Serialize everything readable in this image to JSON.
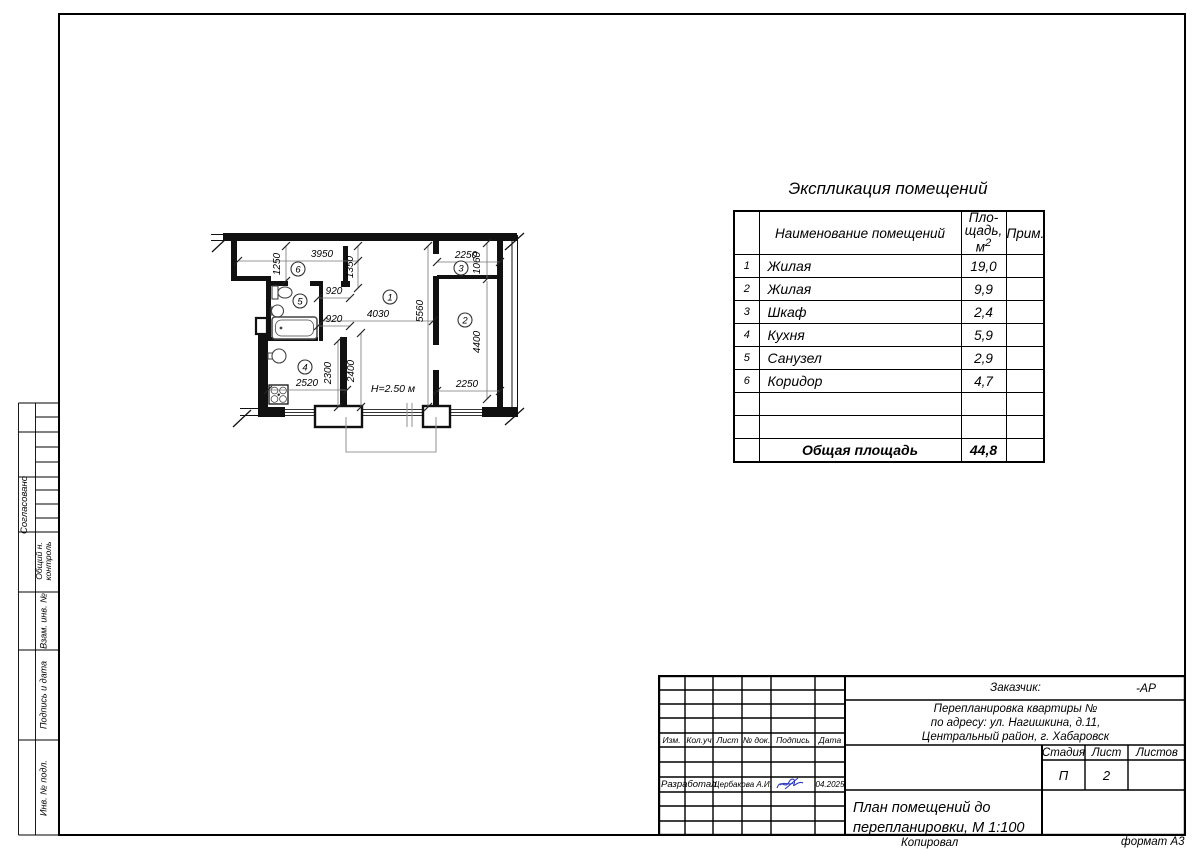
{
  "explication": {
    "title": "Экспликация помещений",
    "header": {
      "name": "Наименование помещений",
      "area_l1": "Пло-",
      "area_l2": "щадь,",
      "area_unit": "м",
      "area_sup": "2",
      "note": "Прим."
    },
    "rows": [
      {
        "num": "1",
        "name": "Жилая",
        "area": "19,0",
        "note": ""
      },
      {
        "num": "2",
        "name": "Жилая",
        "area": "9,9",
        "note": ""
      },
      {
        "num": "3",
        "name": "Шкаф",
        "area": "2,4",
        "note": ""
      },
      {
        "num": "4",
        "name": "Кухня",
        "area": "5,9",
        "note": ""
      },
      {
        "num": "5",
        "name": "Санузел",
        "area": "2,9",
        "note": ""
      },
      {
        "num": "6",
        "name": "Коридор",
        "area": "4,7",
        "note": ""
      },
      {
        "num": "",
        "name": "",
        "area": "",
        "note": ""
      },
      {
        "num": "",
        "name": "",
        "area": "",
        "note": ""
      }
    ],
    "total": {
      "label": "Общая площадь",
      "value": "44,8"
    }
  },
  "plan": {
    "rooms": [
      "1",
      "2",
      "3",
      "4",
      "5",
      "6"
    ],
    "dims": {
      "d3950": "3950",
      "d1250": "1250",
      "d1350": "1350",
      "d920_top": "920",
      "d920_bottom": "920",
      "d4030": "4030",
      "d5560": "5560",
      "d2250_top": "2250",
      "d1060": "1060",
      "d4400": "4400",
      "d2250_bottom": "2250",
      "d2520": "2520",
      "d2300": "2300",
      "d2400": "2400"
    },
    "height_note": "Н=2.50 м"
  },
  "side_strip": {
    "soglasovano": "Согласовано",
    "obshiy_1": "Общий н.",
    "obshiy_2": "контроль",
    "vzam": "Взам. инв. №",
    "podpis": "Подпись и дата",
    "inv": "Инв. № подл."
  },
  "title_block": {
    "customer_label": "Заказчик:",
    "code": "-АР",
    "project_line1": "Перепланировка квартиры №",
    "project_line2": "по адресу: ул. Нагишкина, д.11,",
    "project_line3": "Центральный район, г. Хабаровск",
    "cols": [
      "Изм.",
      "Кол.уч",
      "Лист",
      "№ док.",
      "Подпись",
      "Дата"
    ],
    "developed_label": "Разработал",
    "developed_name": "Щербакова А.И.",
    "developed_date": "04.2025",
    "stage_label": "Стадия",
    "sheet_label": "Лист",
    "sheets_label": "Листов",
    "stage_value": "П",
    "sheet_value": "2",
    "sheets_value": "",
    "doc_title_line1": "План помещений до",
    "doc_title_line2": "перепланировки, М 1:100"
  },
  "footer": {
    "kopiroval": "Копировал",
    "format": "формат А3"
  }
}
